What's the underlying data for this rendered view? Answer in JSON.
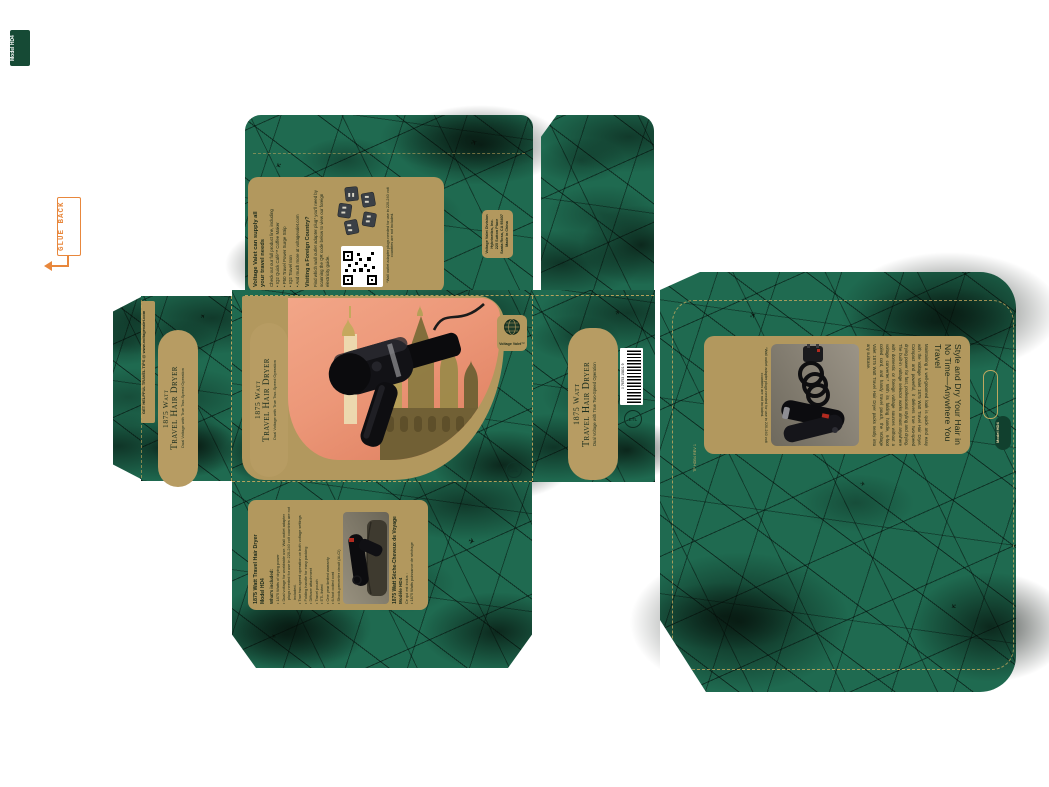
{
  "colors": {
    "green": "#1f6a50",
    "gold": "#b2985e",
    "salmon": "#ed9a7b",
    "orange": "#e8873c",
    "dark_text": "#1c2a1a"
  },
  "icons": {
    "plane": "✈",
    "globe": "globe-grid",
    "registered": "®"
  },
  "slug": {
    "label": "Model HD4"
  },
  "glue_back": {
    "label": "GLUE BACK"
  },
  "strip": {
    "label": "GET HELPFUL TRAVEL TIPS @ www.voltagevalet.com"
  },
  "title": {
    "line1": "1875 Watt",
    "line2": "Travel Hair Dryer",
    "subtitle": "Dual Voltage with True Two-Speed Operation"
  },
  "brand": {
    "name": "Voltage Valet™"
  },
  "top_panel": {
    "heading": "Voltage Valet can supply all your travel needs",
    "intro": "Check out our full product line, including",
    "bullets": [
      "IQ2 Quick Café™ Coffee Maker",
      "P50 Travel Power Surge Strip",
      "IQ2 Travel Iron",
      "And much more at voltagevalet.com"
    ],
    "visiting_heading": "Visiting a Foreign Country?",
    "visiting_body": "Find which wall outlet adapter plug* you'll need by scanning the QR code below to view our foreign electricity guide.",
    "footnote": "*Wall outlet adapter plugs needed for use in 220-240 volt countries are not included."
  },
  "address_box": {
    "lines": [
      "Voltage Valet Division",
      "Hybrinetics, Inc.",
      "225 Sutton Place",
      "Santa Rosa, CA 95407",
      "Made in China"
    ]
  },
  "features_panel": {
    "heading": "1875 Watt Travel Hair Dryer",
    "model": "Model HD4",
    "included_label": "What's included:",
    "bullets": [
      "1875 Watts of drying power",
      "Dual voltage for worldwide use. Wall outlet adapter plugs needed for use in 220-240 volt countries are not included.",
      "True two-speed operation on both voltage settings",
      "Folding handle for easy packing",
      "Diffuser attachment",
      "Travel pouch",
      "ETL listed",
      "One year limited warranty"
    ],
    "extra_bullets": [
      "6-foot coiled cord",
      "Shock-preventer circuit (ALCI)"
    ],
    "fr_heading": "1875 Watt Sèche-Cheveux de Voyage",
    "fr_model": "Modèle HD4",
    "fr_included_label": "Ce qui est inclus :",
    "fr_bullets": [
      "1875 Watts puissance de séchage"
    ]
  },
  "back_panel": {
    "heading": "Style and Dry Your Hair in No Time—Anywhere You Travel",
    "body": "Maintaining a well-groomed look is quick and easy with the Voltage Valet 1875 Watt Travel Hair Dryer. Compact and powerful, it delivers true two-speed drying power for fast, professional styling and drying. The built-in voltage selector works almost anywhere with domestic or foreign voltage sources without a voltage converter.* With its folding handle, 6-foot coiled cord, and handy travel pouch, the Voltage Valet 1875 Watt Travel Hair Dryer packs neatly into any suitcase.",
    "footnote": "*Wall outlet adapter plugs needed for use in 220-240 volt countries are not included.",
    "print_code": "TP HDB4 REV 1"
  },
  "barcode": {
    "number": "0 76753 15801 9"
  },
  "etl": {
    "label": "ETL"
  },
  "model_tab": {
    "label": "Model HD4"
  }
}
